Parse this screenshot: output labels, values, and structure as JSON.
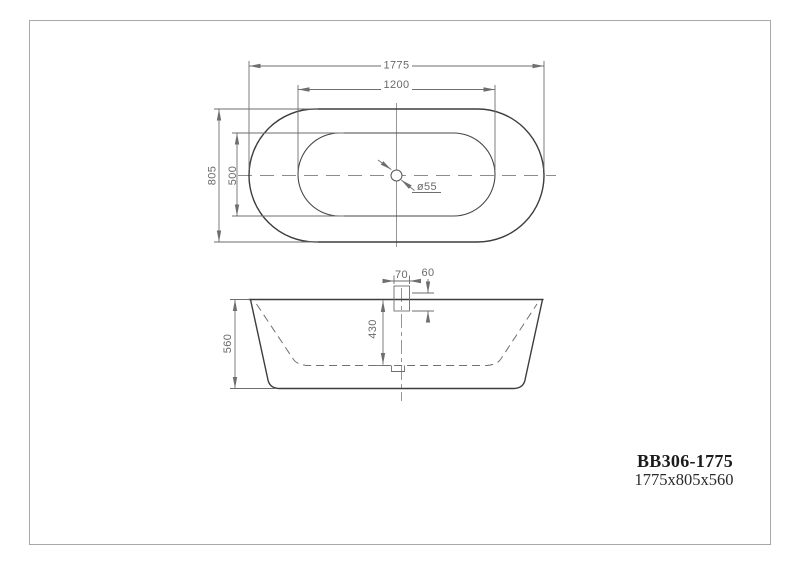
{
  "title_block": {
    "model": "BB306-1775",
    "overall_size": "1775x805x560"
  },
  "top_view": {
    "outer_length": "1775",
    "inner_length": "1200",
    "outer_width": "805",
    "inner_width": "500",
    "drain_diameter": "ø55"
  },
  "side_view": {
    "overall_height": "560",
    "inner_depth": "430",
    "overflow_width": "70",
    "overflow_offset": "60"
  },
  "colors": {
    "outline": "#3d3d3d",
    "dimension_lines": "#6e6e6e",
    "centerline": "#8c8c8c",
    "page_border": "#a8a8a8",
    "title_text": "#1c1c1c"
  }
}
